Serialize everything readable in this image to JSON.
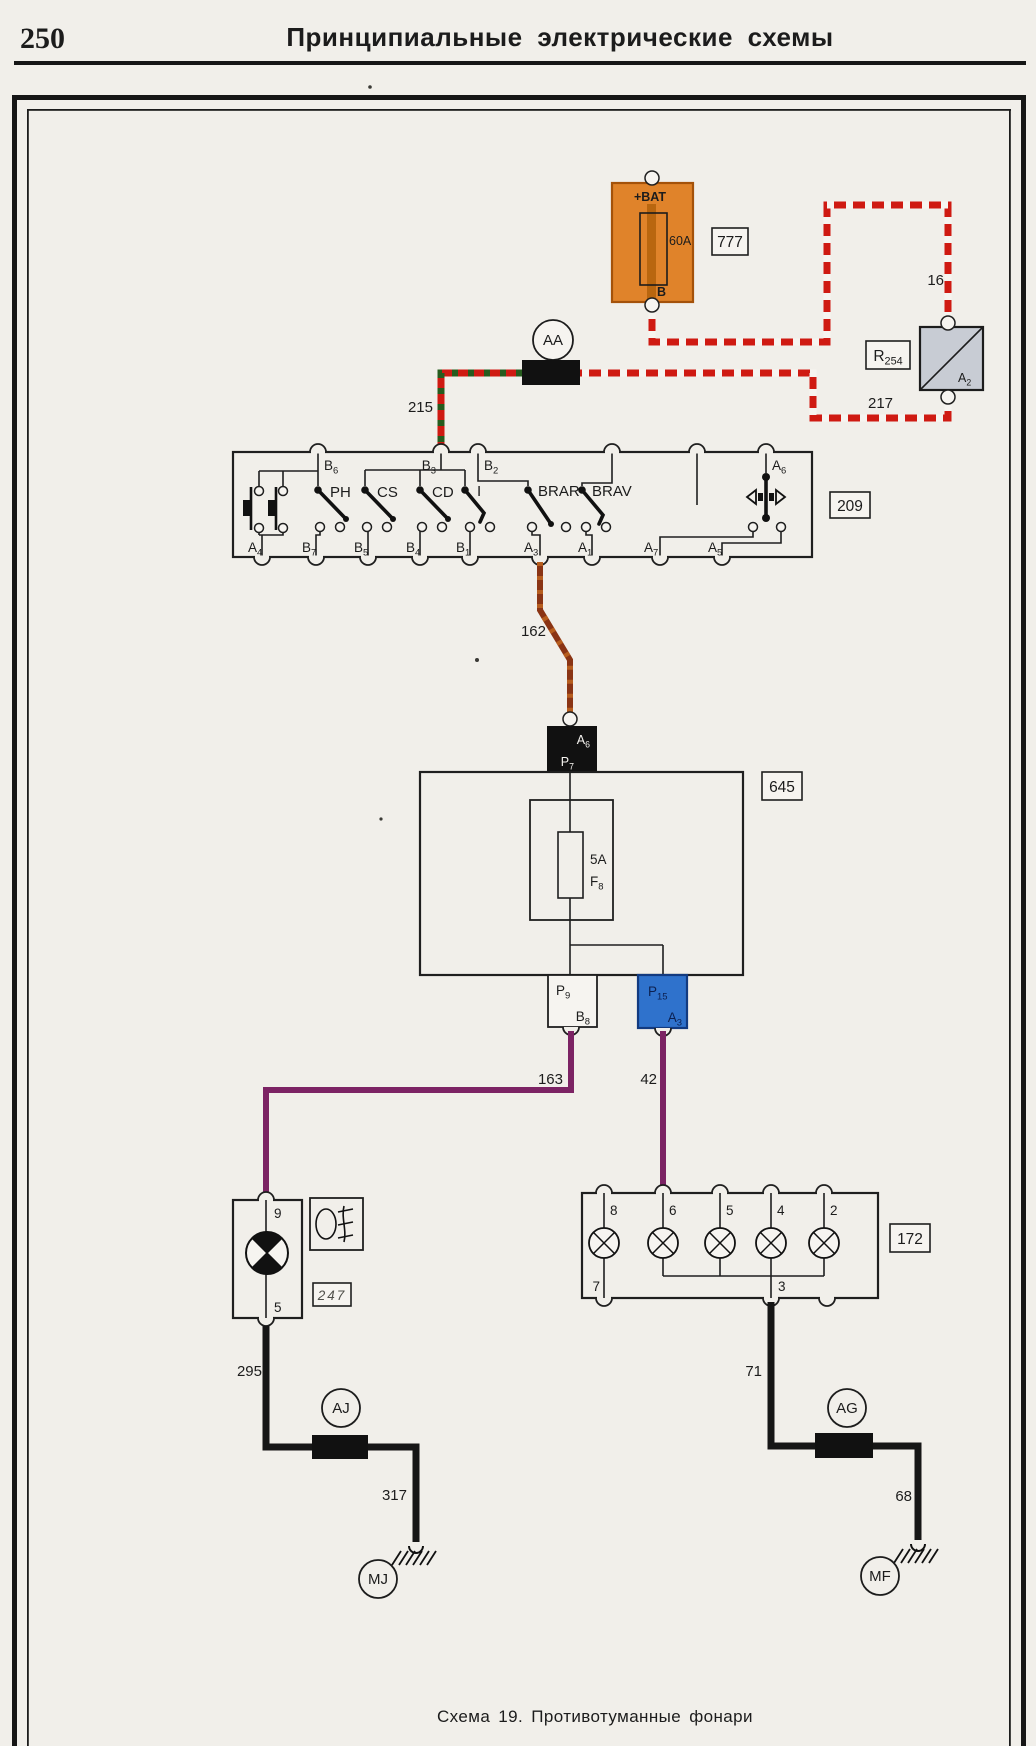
{
  "page": {
    "number": "250",
    "title": "Принципиальные  электрические  схемы",
    "caption": "Схема  19.  Противотуманные  фонари"
  },
  "battery": {
    "ref": "777",
    "terminal_top": "+BAT",
    "fuse_rating": "60A",
    "terminal_bottom": "B"
  },
  "relay": {
    "ref": "R254",
    "pin": "A2"
  },
  "switch_unit": {
    "ref": "209",
    "top_pins": [
      "B6",
      "B3",
      "B2",
      "A6"
    ],
    "bottom_pins": [
      "A4",
      "B7",
      "B5",
      "B4",
      "B1",
      "A3",
      "A1",
      "A7",
      "A5"
    ],
    "switches": [
      "PH",
      "CS",
      "CD",
      "I",
      "BRAR",
      "BRAV"
    ]
  },
  "fuse_unit": {
    "ref": "645",
    "fuse_rating": "5A",
    "fuse_name": "F8",
    "conn_in": {
      "row1": "A6",
      "row2": "P7"
    },
    "conn_left": {
      "row1": "P9",
      "row2": "B8"
    },
    "conn_right": {
      "row1": "P15",
      "row2": "A3"
    }
  },
  "left_lamp": {
    "ref": "247",
    "pin_top": "9",
    "pin_bottom": "5"
  },
  "lamp_unit": {
    "ref": "172",
    "top_pins": [
      "8",
      "6",
      "5",
      "4",
      "2"
    ],
    "bottom_pins": [
      "7",
      "3"
    ]
  },
  "junctions": {
    "aa": "AA",
    "aj": "AJ",
    "ag": "AG"
  },
  "grounds": {
    "mj": "MJ",
    "mf": "MF"
  },
  "wires": {
    "w16": "16",
    "w215": "215",
    "w217": "217",
    "w162": "162",
    "w163": "163",
    "w42": "42",
    "w295": "295",
    "w317": "317",
    "w71": "71",
    "w68": "68"
  },
  "colors": {
    "power_wire": "#cf1a12",
    "wire215_stripe": "#265c1e",
    "wire162": "#8a3414",
    "signal_wire": "#7c2364",
    "ground_wire": "#161616",
    "battery_fill": "#e0832a",
    "relay_fill": "#c8ccd4",
    "connector_blue": "#2f72cc"
  }
}
